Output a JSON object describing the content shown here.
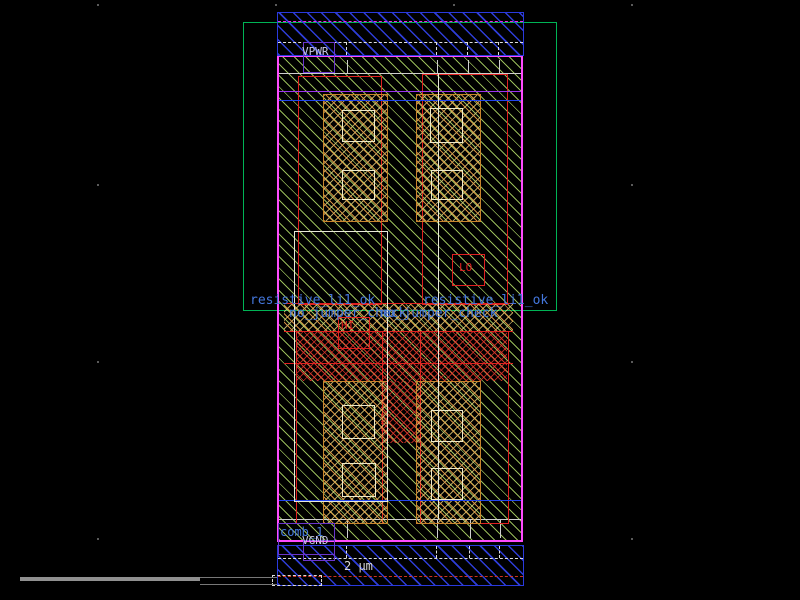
{
  "app": {
    "type": "ic-layout-editor-canvas",
    "description": "VLSI standard-cell layout view with power rails, wells, diffusion, contacts and net labels"
  },
  "net_labels": {
    "power": "VPWR",
    "ground": "VGND",
    "comb": "comb_1"
  },
  "terminal_labels": {
    "hi": "HI",
    "lo": "LO"
  },
  "rule_labels": {
    "resistive_left": "resistive_li1_ok",
    "resistive_right": "resistive_li1_ok",
    "jumper_left": "no_jumper_check",
    "jumper_right": "no_jumper_check"
  },
  "scale_bar": {
    "label": "2 µm"
  },
  "colors": {
    "background": "#000000",
    "metal1_blue": "#3040e2",
    "well_green_hatch": "#b0d868",
    "nwell_boundary_green": "#00b355",
    "cell_boundary_magenta": "#ff4bff",
    "poly_red": "#e02020",
    "diffusion_orange": "#c8842c",
    "contact_white": "#efe9c8",
    "label_blue": "#4477dd",
    "label_net": "#c8c8e8",
    "purple_label_box": "#6a35cc",
    "scrollbar_gray": "#909090"
  }
}
